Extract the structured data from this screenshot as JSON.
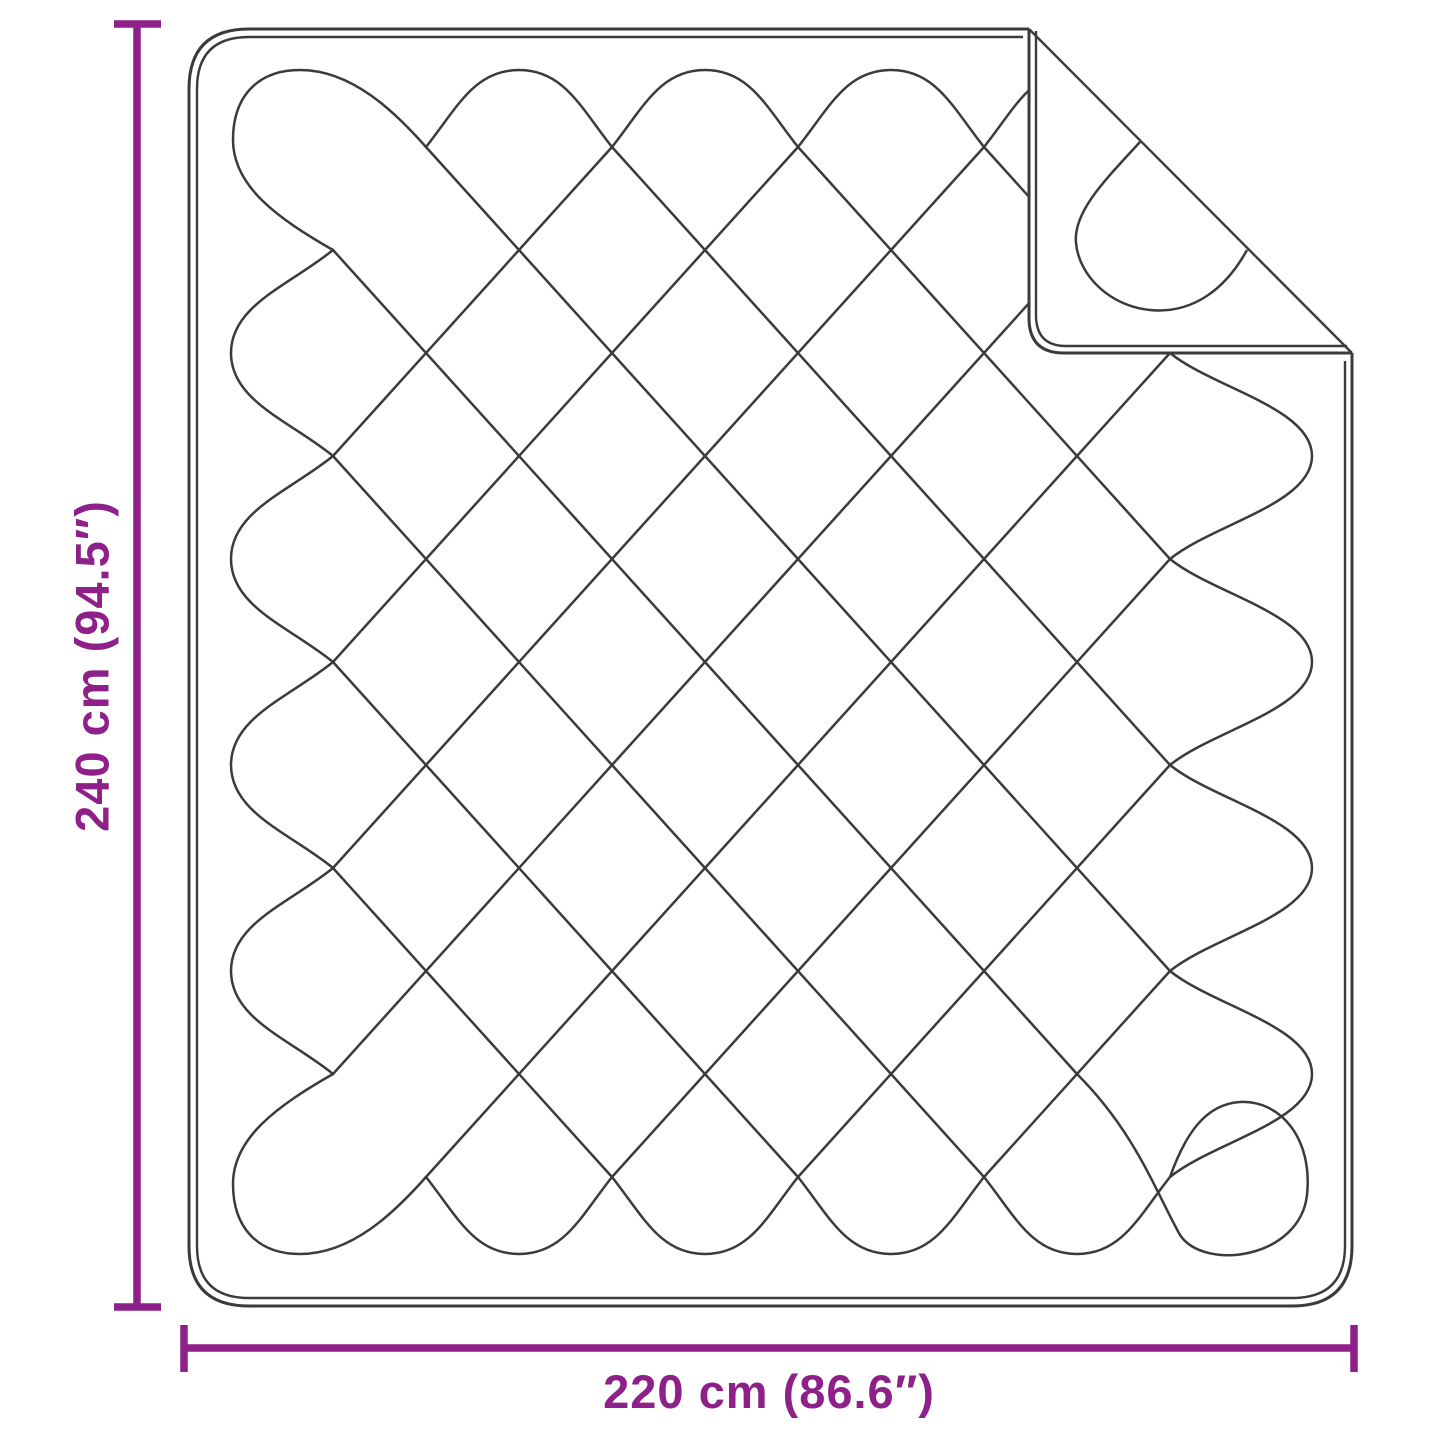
{
  "diagram": {
    "kind": "product-dimension-diagram",
    "subject": "quilted-blanket-with-folded-corner",
    "height_dimension": {
      "label": "240 cm (94.5″)",
      "orientation": "vertical"
    },
    "width_dimension": {
      "label": "220 cm (86.6″)",
      "orientation": "horizontal"
    },
    "colors": {
      "dimension_accent": "#8E2189",
      "line_art": "#3B3B3D",
      "background": "#FFFFFF"
    }
  }
}
